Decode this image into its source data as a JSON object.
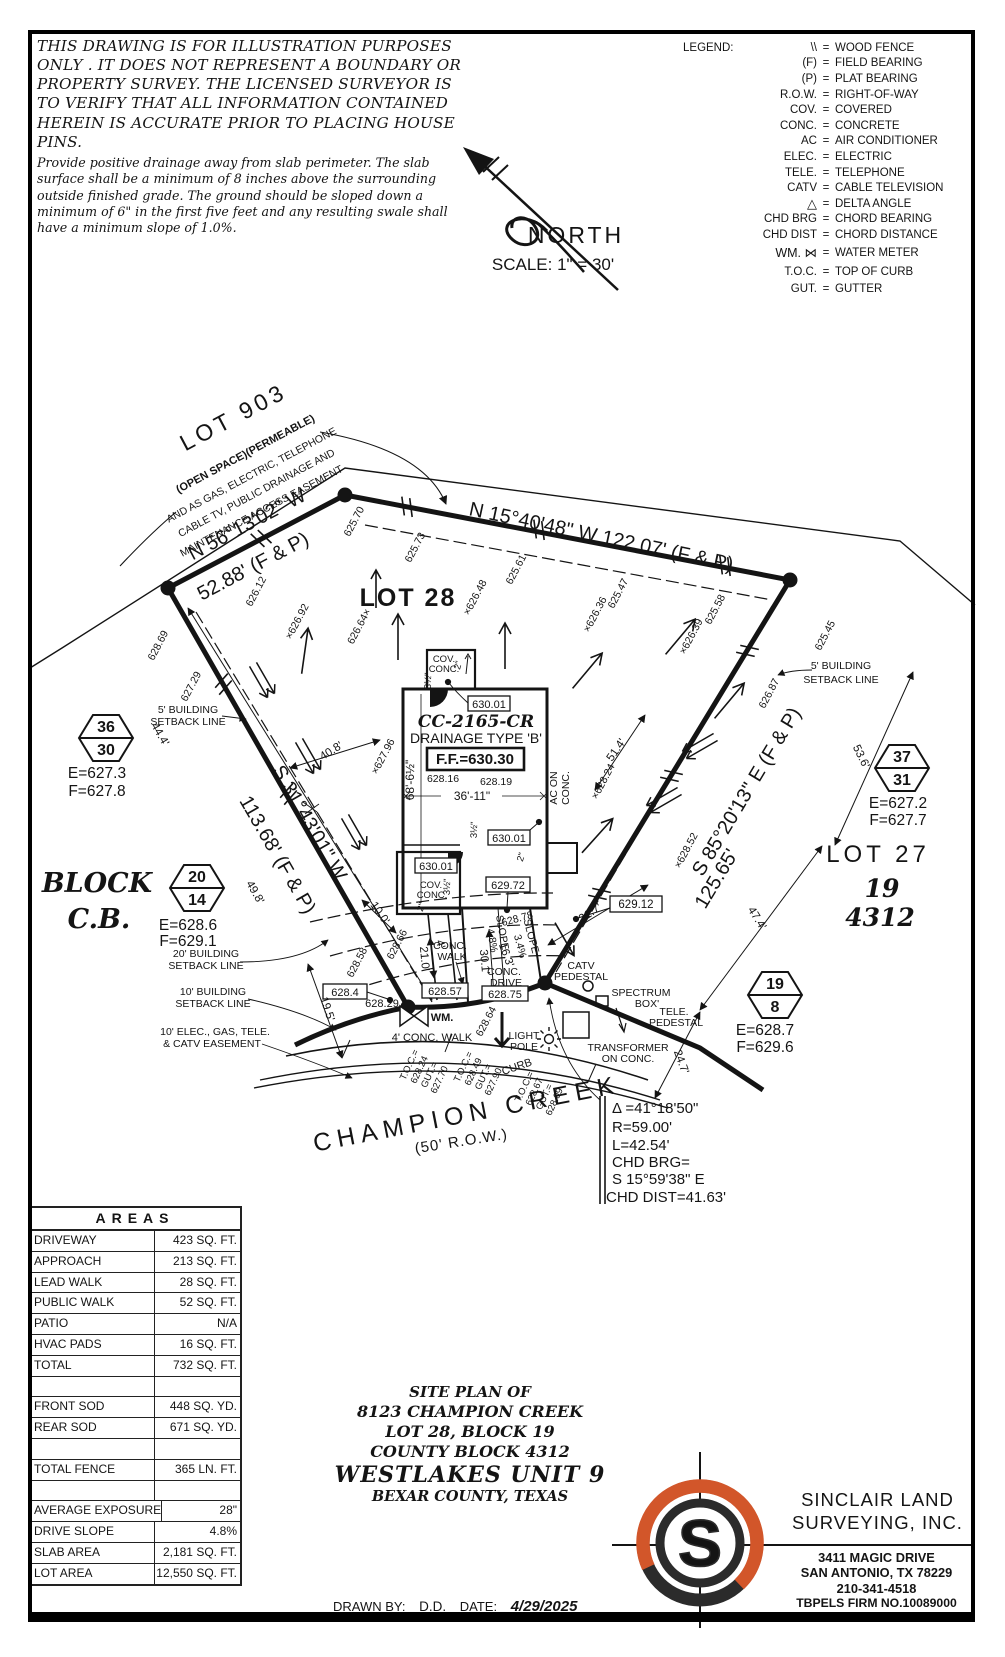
{
  "disclaimer": {
    "para1": "THIS DRAWING IS FOR ILLUSTRATION PURPOSES ONLY . IT DOES NOT REPRESENT A BOUNDARY OR PROPERTY SURVEY. THE LICENSED SURVEYOR IS TO VERIFY THAT ALL INFORMATION CONTAINED HEREIN IS ACCURATE PRIOR TO PLACING HOUSE PINS.",
    "para2": "Provide positive drainage away from slab perimeter. The slab surface shall be a minimum of 8 inches above the surrounding outside finished grade. The ground should be sloped down a minimum of 6\" in the first five feet and any resulting swale shall have a minimum slope of 1.0%."
  },
  "legend": {
    "title": "LEGEND:",
    "eq": "=",
    "items": [
      {
        "sym": "\\\\",
        "desc": "WOOD FENCE"
      },
      {
        "sym": "(F)",
        "desc": "FIELD BEARING"
      },
      {
        "sym": "(P)",
        "desc": "PLAT BEARING"
      },
      {
        "sym": "R.O.W.",
        "desc": "RIGHT-OF-WAY"
      },
      {
        "sym": "COV.",
        "desc": "COVERED"
      },
      {
        "sym": "CONC.",
        "desc": "CONCRETE"
      },
      {
        "sym": "AC",
        "desc": "AIR CONDITIONER"
      },
      {
        "sym": "ELEC.",
        "desc": "ELECTRIC"
      },
      {
        "sym": "TELE.",
        "desc": "TELEPHONE"
      },
      {
        "sym": "CATV",
        "desc": "CABLE TELEVISION"
      },
      {
        "sym": "△",
        "desc": "DELTA ANGLE"
      },
      {
        "sym": "CHD BRG",
        "desc": "CHORD BEARING"
      },
      {
        "sym": "CHD DIST",
        "desc": "CHORD DISTANCE"
      },
      {
        "sym": "WM. ⋈",
        "desc": "WATER METER"
      },
      {
        "sym": "T.O.C.",
        "desc": "TOP OF CURB"
      },
      {
        "sym": "GUT.",
        "desc": "GUTTER"
      }
    ]
  },
  "north": {
    "label": "NORTH",
    "scale": "SCALE:  1\" = 30'"
  },
  "plan": {
    "lot903": {
      "name": "LOT 903",
      "sub": "(OPEN SPACE)(PERMEABLE)",
      "e1": "AND AS GAS, ELECTRIC, TELEPHONE",
      "e2": "CABLE TV, PUBLIC DRAINAGE AND",
      "e3": "MAINTENANCE ACCESS EASEMENT"
    },
    "bearings": {
      "nw1": "N 56°13'02\" W",
      "nw2": "52.88' (F & P)",
      "top": "N 15°40'48\" W  122.07' (F & P)",
      "west1": "S 31°43'01\" W",
      "west2": "113.68' (F & P)",
      "east1": "S 85°20'13\" E  (F & P)",
      "east2": "125.65'"
    },
    "lots": {
      "lot28": "LOT 28",
      "lot27": "LOT 27",
      "block19": "19",
      "cb4312": "4312",
      "block_l1": "BLOCK",
      "block_l2": "C.B."
    },
    "house": {
      "model": "CC-2165-CR",
      "drainage": "DRAINAGE TYPE 'B'",
      "ff": "F.F.=630.30",
      "e1": "628.16",
      "e2": "628.19",
      "width": "36'-11\"",
      "depth": "68'-6½\"",
      "ac1": "AC ON",
      "ac2": "CONC.",
      "cov": "COV.",
      "conc": "CONC.",
      "dim2": "2\"",
      "dim35": "3½\""
    },
    "boxed": {
      "b630": "630.01",
      "b62972": "629.72",
      "b6284": "628.4",
      "b62857": "628.57",
      "b62875": "628.75",
      "b62912": "629.12"
    },
    "spots": {
      "s1": "625.70",
      "s2": "625.73",
      "s3": "625.61",
      "s4": "×626.48",
      "s5": "×626.36",
      "s6": "625.47",
      "s7": "×626.39",
      "s8": "625.58",
      "s9": "625.45",
      "s10": "626.87",
      "s11": "×628.24",
      "s12": "×628.52",
      "s13": "×627.96",
      "s14": "×626.92",
      "s15": "626.64×",
      "s16": "626.12",
      "s17": "628.69",
      "s18": "627.29",
      "s19": "628.58",
      "s20": "628.66",
      "s21": "628.78",
      "s22": "628.64",
      "s23": "628.29"
    },
    "dims": {
      "d44": "44.4'",
      "d49": "49.8'",
      "d195": "19.5'",
      "d100": "10.0'",
      "d210": "21.0'",
      "d4": "4'",
      "d301": "30.1'",
      "d163": "16.3'",
      "d217": "21.7'",
      "d247": "24.7'",
      "d474": "47.4'",
      "d536": "53.6'",
      "d514": "51.4'",
      "d408": "40.8'",
      "slope1": "4.8%",
      "slope2": "3.4%",
      "slope_word": "SLOPE"
    },
    "setbacks": {
      "s5a": "5' BUILDING",
      "s5b": "SETBACK LINE",
      "s20a": "20' BUILDING",
      "s20b": "SETBACK LINE",
      "s10a": "10' BUILDING",
      "s10b": "SETBACK LINE",
      "ease1": "10' ELEC., GAS, TELE.",
      "ease2": "& CATV EASEMENT"
    },
    "street": {
      "name": "CHAMPION CREEK",
      "row": "(50' R.O.W.)",
      "curb": "CURB",
      "walk4": "4' CONC. WALK",
      "cwalk1": "CONC.",
      "cwalk2": "WALK",
      "cdrive1": "CONC.",
      "cdrive2": "DRIVE",
      "wm": "WM.",
      "light1": "LIGHT",
      "light2": "POLE",
      "catv1": "CATV",
      "catv2": "PEDESTAL",
      "spect1": "SPECTRUM",
      "spect2": "BOX'",
      "telep1": "TELE.",
      "telep2": "PEDESTAL",
      "trans1": "TRANSFORMER",
      "trans2": "ON CONC."
    },
    "toc": {
      "t": "T.O.C.=",
      "g": "GUT.=",
      "t1v1": "628.24",
      "t1v2": "627.70",
      "t2v1": "628.49",
      "t2v2": "627.90",
      "t3v1": "628.67",
      "t3v2": "628.09"
    },
    "curve": {
      "l1": "Δ =41°18'50\"",
      "l2": "R=59.00'",
      "l3": "L=42.54'",
      "l4": "CHD BRG=",
      "l5": "S 15°59'38\" E",
      "l6": "CHD DIST=41.63'"
    },
    "hex": {
      "h1t": "36",
      "h1b": "30",
      "h1e": "E=627.3",
      "h1f": "F=627.8",
      "h2t": "20",
      "h2b": "14",
      "h2e": "E=628.6",
      "h2f": "F=629.1",
      "h3t": "37",
      "h3b": "31",
      "h3e": "E=627.2",
      "h3f": "F=627.7",
      "h4t": "19",
      "h4b": "8",
      "h4e": "E=628.7",
      "h4f": "F=629.6"
    }
  },
  "areas_table": {
    "title": "AREAS",
    "rows": [
      {
        "label": "DRIVEWAY",
        "value": "423 SQ. FT."
      },
      {
        "label": "APPROACH",
        "value": "213 SQ. FT."
      },
      {
        "label": "LEAD WALK",
        "value": "28 SQ. FT."
      },
      {
        "label": "PUBLIC WALK",
        "value": "52 SQ. FT."
      },
      {
        "label": "PATIO",
        "value": "N/A"
      },
      {
        "label": "HVAC PADS",
        "value": "16 SQ. FT."
      },
      {
        "label": "TOTAL",
        "value": "732 SQ. FT."
      },
      {
        "label": "",
        "value": ""
      },
      {
        "label": "FRONT SOD",
        "value": "448 SQ. YD."
      },
      {
        "label": "REAR SOD",
        "value": "671 SQ. YD."
      },
      {
        "label": "",
        "value": ""
      },
      {
        "label": "TOTAL FENCE",
        "value": "365 LN. FT."
      },
      {
        "label": "",
        "value": ""
      },
      {
        "label": "AVERAGE EXPOSURE",
        "value": "28\""
      },
      {
        "label": "DRIVE SLOPE",
        "value": "4.8%"
      },
      {
        "label": "SLAB AREA",
        "value": "2,181 SQ. FT."
      },
      {
        "label": "LOT AREA",
        "value": "12,550 SQ. FT."
      }
    ]
  },
  "title_block": {
    "l1": "SITE PLAN OF",
    "l2": "8123 CHAMPION CREEK",
    "l3": "LOT 28, BLOCK 19",
    "l4": "COUNTY BLOCK 4312",
    "l5": "WESTLAKES UNIT 9",
    "l6": "BEXAR COUNTY, TEXAS"
  },
  "drawn": {
    "by_label": "DRAWN BY:",
    "by": "D.D.",
    "date_label": "DATE:",
    "date": "4/29/2025"
  },
  "surveyor": {
    "name1": "SINCLAIR LAND",
    "name2": "SURVEYING, INC.",
    "addr1": "3411 MAGIC DRIVE",
    "addr2": "SAN ANTONIO, TX 78229",
    "phone": "210-341-4518",
    "firm": "TBPELS FIRM NO.10089000",
    "job": "JOB NUMBER: S-202581151",
    "logo_letter": "S"
  },
  "colors": {
    "orange": "#D2562A",
    "ink": "#141414"
  }
}
